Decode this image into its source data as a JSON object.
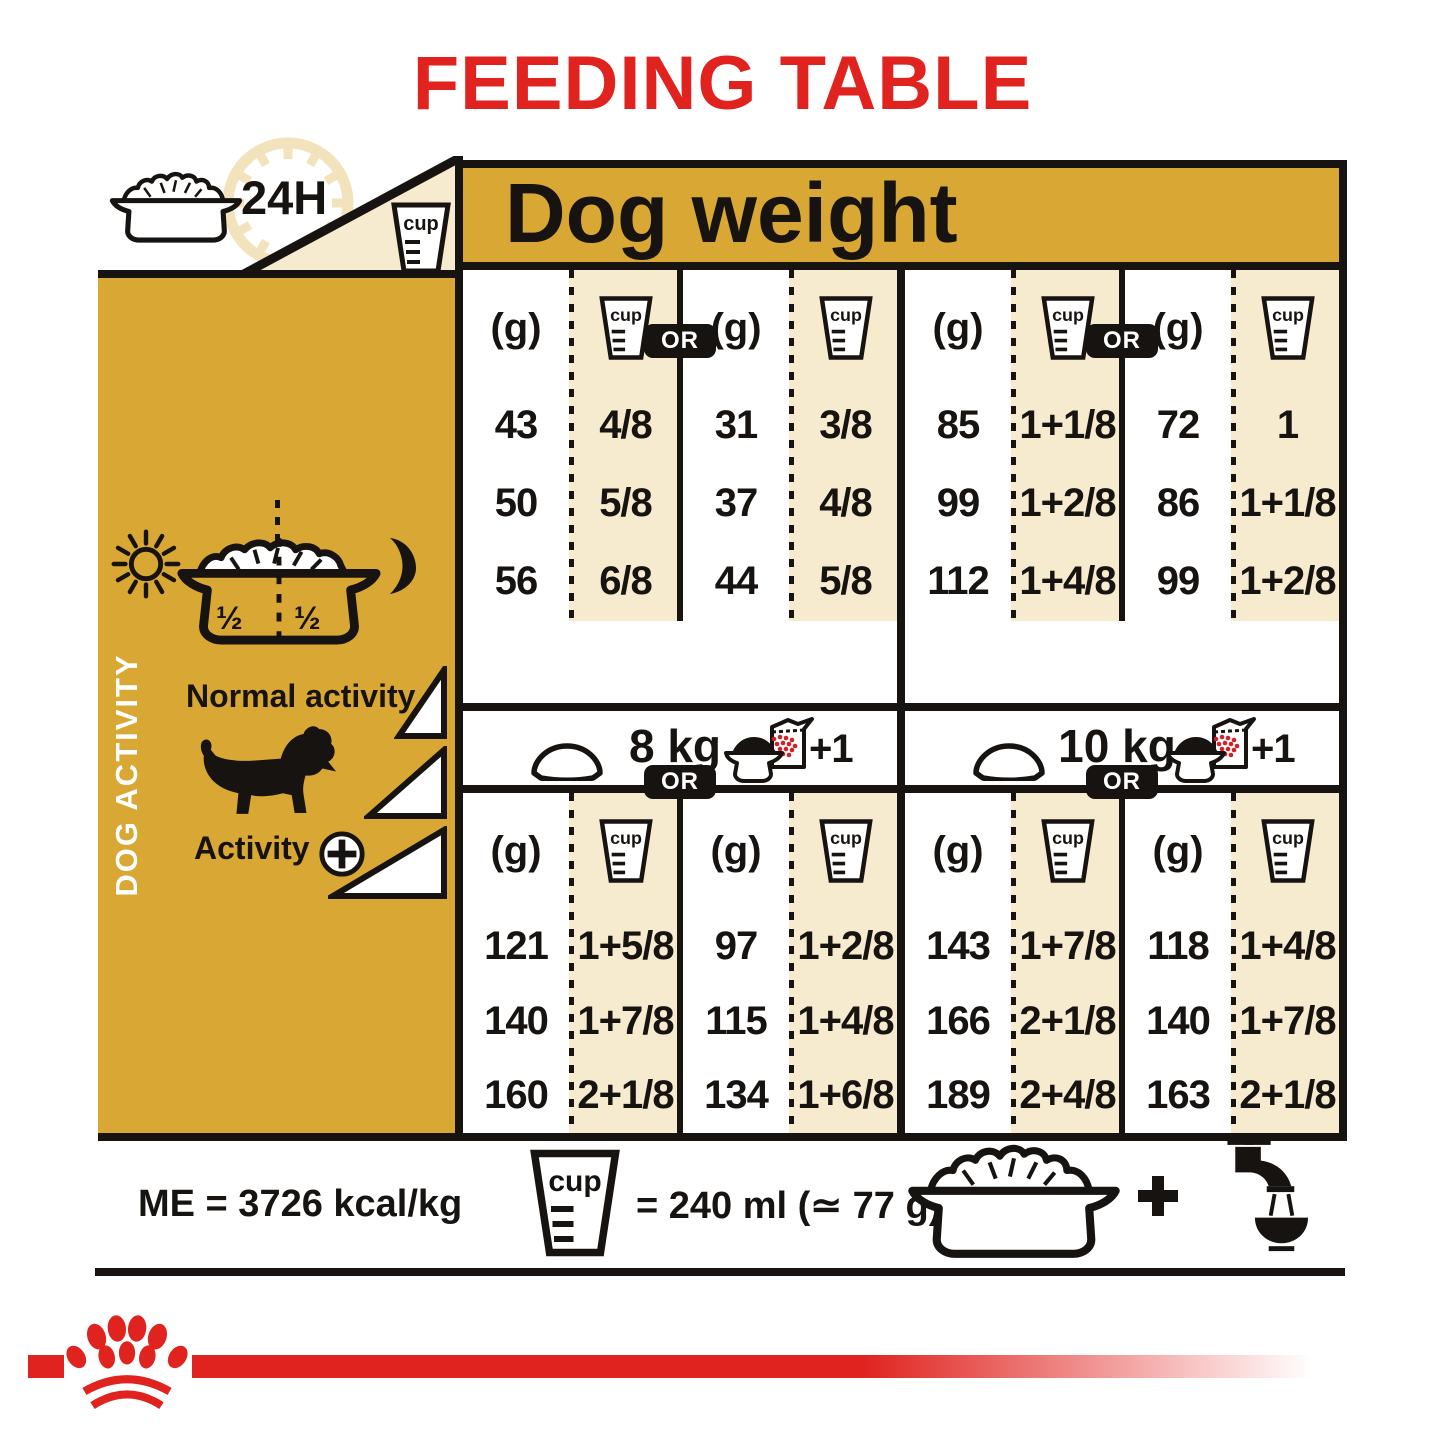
{
  "title": "FEEDING TABLE",
  "top": {
    "duration_label": "24H",
    "cup_label": "cup"
  },
  "dog_weight_header": "Dog weight",
  "sidebar": {
    "vertical_label": "DOG ACTIVITY",
    "bowl_half_left": "½",
    "bowl_half_right": "½",
    "normal_activity_label": "Normal activity",
    "activity_label": "Activity"
  },
  "sections": [
    {
      "weight": "2 kg",
      "or_label": "OR",
      "supplement": "+1/2",
      "unit_label": "(g)",
      "cup_label": "cup",
      "rows": [
        {
          "dry_g": "43",
          "dry_cup": "4/8",
          "mix_g": "31",
          "mix_cup": "3/8"
        },
        {
          "dry_g": "50",
          "dry_cup": "5/8",
          "mix_g": "37",
          "mix_cup": "4/8"
        },
        {
          "dry_g": "56",
          "dry_cup": "6/8",
          "mix_g": "44",
          "mix_cup": "5/8"
        }
      ]
    },
    {
      "weight": "5 kg",
      "or_label": "OR",
      "supplement": "+1/2",
      "unit_label": "(g)",
      "cup_label": "cup",
      "rows": [
        {
          "dry_g": "85",
          "dry_cup": "1+1/8",
          "mix_g": "72",
          "mix_cup": "1"
        },
        {
          "dry_g": "99",
          "dry_cup": "1+2/8",
          "mix_g": "86",
          "mix_cup": "1+1/8"
        },
        {
          "dry_g": "112",
          "dry_cup": "1+4/8",
          "mix_g": "99",
          "mix_cup": "1+2/8"
        }
      ]
    },
    {
      "weight": "8 kg",
      "or_label": "OR",
      "supplement": "+1",
      "unit_label": "(g)",
      "cup_label": "cup",
      "rows": [
        {
          "dry_g": "121",
          "dry_cup": "1+5/8",
          "mix_g": "97",
          "mix_cup": "1+2/8"
        },
        {
          "dry_g": "140",
          "dry_cup": "1+7/8",
          "mix_g": "115",
          "mix_cup": "1+4/8"
        },
        {
          "dry_g": "160",
          "dry_cup": "2+1/8",
          "mix_g": "134",
          "mix_cup": "1+6/8"
        }
      ]
    },
    {
      "weight": "10 kg",
      "or_label": "OR",
      "supplement": "+1",
      "unit_label": "(g)",
      "cup_label": "cup",
      "rows": [
        {
          "dry_g": "143",
          "dry_cup": "1+7/8",
          "mix_g": "118",
          "mix_cup": "1+4/8"
        },
        {
          "dry_g": "166",
          "dry_cup": "2+1/8",
          "mix_g": "140",
          "mix_cup": "1+7/8"
        },
        {
          "dry_g": "189",
          "dry_cup": "2+4/8",
          "mix_g": "163",
          "mix_cup": "2+1/8"
        }
      ]
    }
  ],
  "footer": {
    "me_label": "ME = 3726 kcal/kg",
    "cup_label": "cup",
    "cup_equivalence": "= 240 ml (≃ 77 g)"
  },
  "colors": {
    "brand_red": "#E0231F",
    "gold": "#D9A733",
    "cream": "#F6EBCE",
    "ink": "#171310"
  }
}
